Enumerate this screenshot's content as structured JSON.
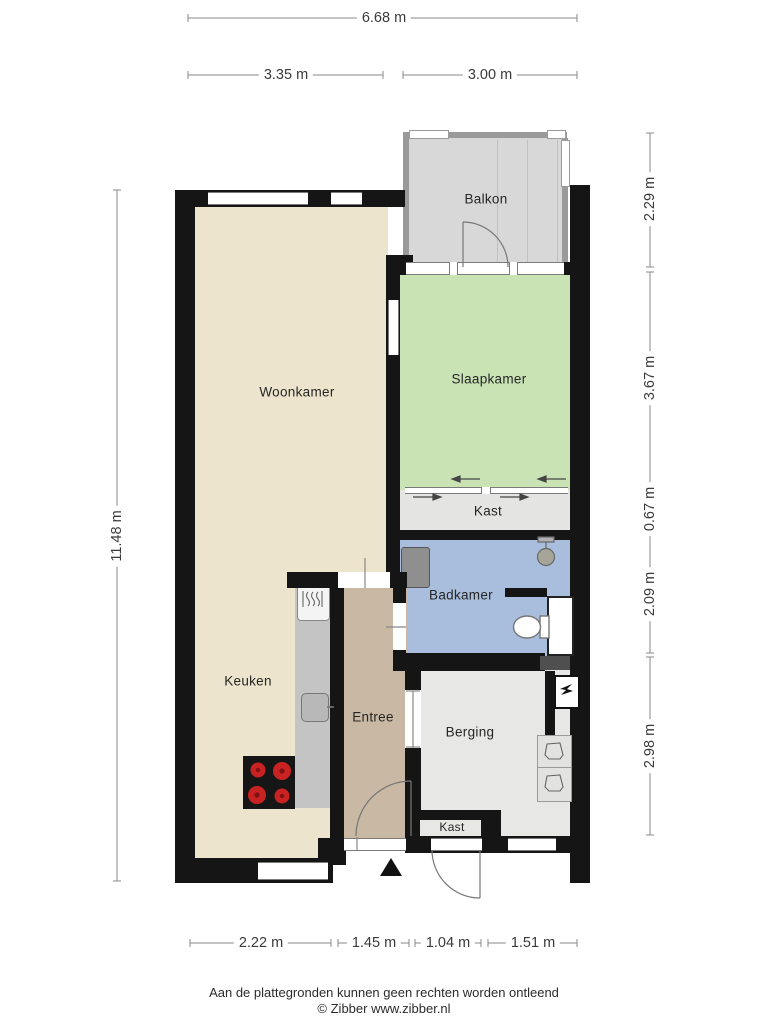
{
  "page": {
    "disclaimer": "Aan de plattegronden kunnen geen rechten worden ontleend",
    "copyright": "© Zibber www.zibber.nl"
  },
  "rooms": {
    "balkon": "Balkon",
    "woonkamer": "Woonkamer",
    "slaapkamer": "Slaapkamer",
    "kast_top": "Kast",
    "badkamer": "Badkamer",
    "keuken": "Keuken",
    "entree": "Entree",
    "berging": "Berging",
    "kast_bottom": "Kast"
  },
  "dimensions": {
    "top_total": "6.68 m",
    "top_left": "3.35 m",
    "top_right": "3.00 m",
    "left_total": "11.48 m",
    "right_balkon": "2.29 m",
    "right_slaapkamer": "3.67 m",
    "right_kast": "0.67 m",
    "right_badkamer": "2.09 m",
    "right_berging": "2.98 m",
    "bottom_woonkamer": "2.22 m",
    "bottom_entree": "1.45 m",
    "bottom_kast": "1.04 m",
    "bottom_berging": "1.51 m"
  },
  "colors": {
    "woonkamer_keuken_fill": "#ece4cc",
    "slaapkamer_fill": "#c9e3b5",
    "badkamer_fill": "#a9bedd",
    "entree_fill": "#c9b8a4",
    "berging_kast_fill": "#e7e7e5",
    "balkon_fill": "#d8d8d8",
    "counter": "#c4c4c4",
    "wall": "#151515",
    "burner_red": "#c92222"
  },
  "icons": {
    "north_arrow": "black triangle pointing up",
    "stove": "cooktop with 4 red burners",
    "oven": "built-in oven with heat squiggles",
    "sink": "kitchen sink square with tap",
    "toilet": "toilet bowl top view",
    "shower": "shower head on riser",
    "radiator": "wall radiator",
    "mv_unit": "mechanical ventilation box",
    "appliance": "washer / dryer position outline"
  }
}
